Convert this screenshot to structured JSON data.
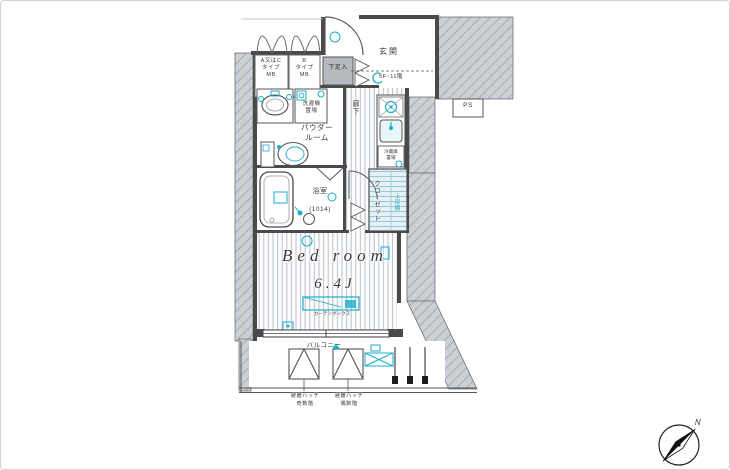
{
  "colors": {
    "accent_cyan": "#18aecb",
    "wall_dark": "#4a4a4a",
    "concrete_gray": "#ccd0d4"
  },
  "plan": {
    "meter_boxes": {
      "left": "A又はC\nタイプ\nMB",
      "right": "B\nタイプ\nMB"
    },
    "entrance": {
      "label": "玄関",
      "floor_note": "5F~11階",
      "shoe_box": "下足入"
    },
    "pipe_space": "PS",
    "laundry": "洗濯機\n置場",
    "powder_room": "パウダー\nルーム",
    "corridor": "廊下",
    "bathroom": {
      "label": "浴室",
      "size": "(1014)"
    },
    "refrigerator": "冷蔵庫\n置場",
    "closet": {
      "label": "クローゼット",
      "shelf": "上部棚"
    },
    "bedroom": {
      "label": "Bed room",
      "size": "6.4J",
      "curtain_box": "カーテンボックス"
    },
    "balcony": {
      "label": "バルコニー",
      "hatch_left": "避難ハッチ\n奇数階",
      "hatch_right": "避難ハッチ\n偶数階"
    },
    "compass": {
      "north": "N"
    }
  }
}
